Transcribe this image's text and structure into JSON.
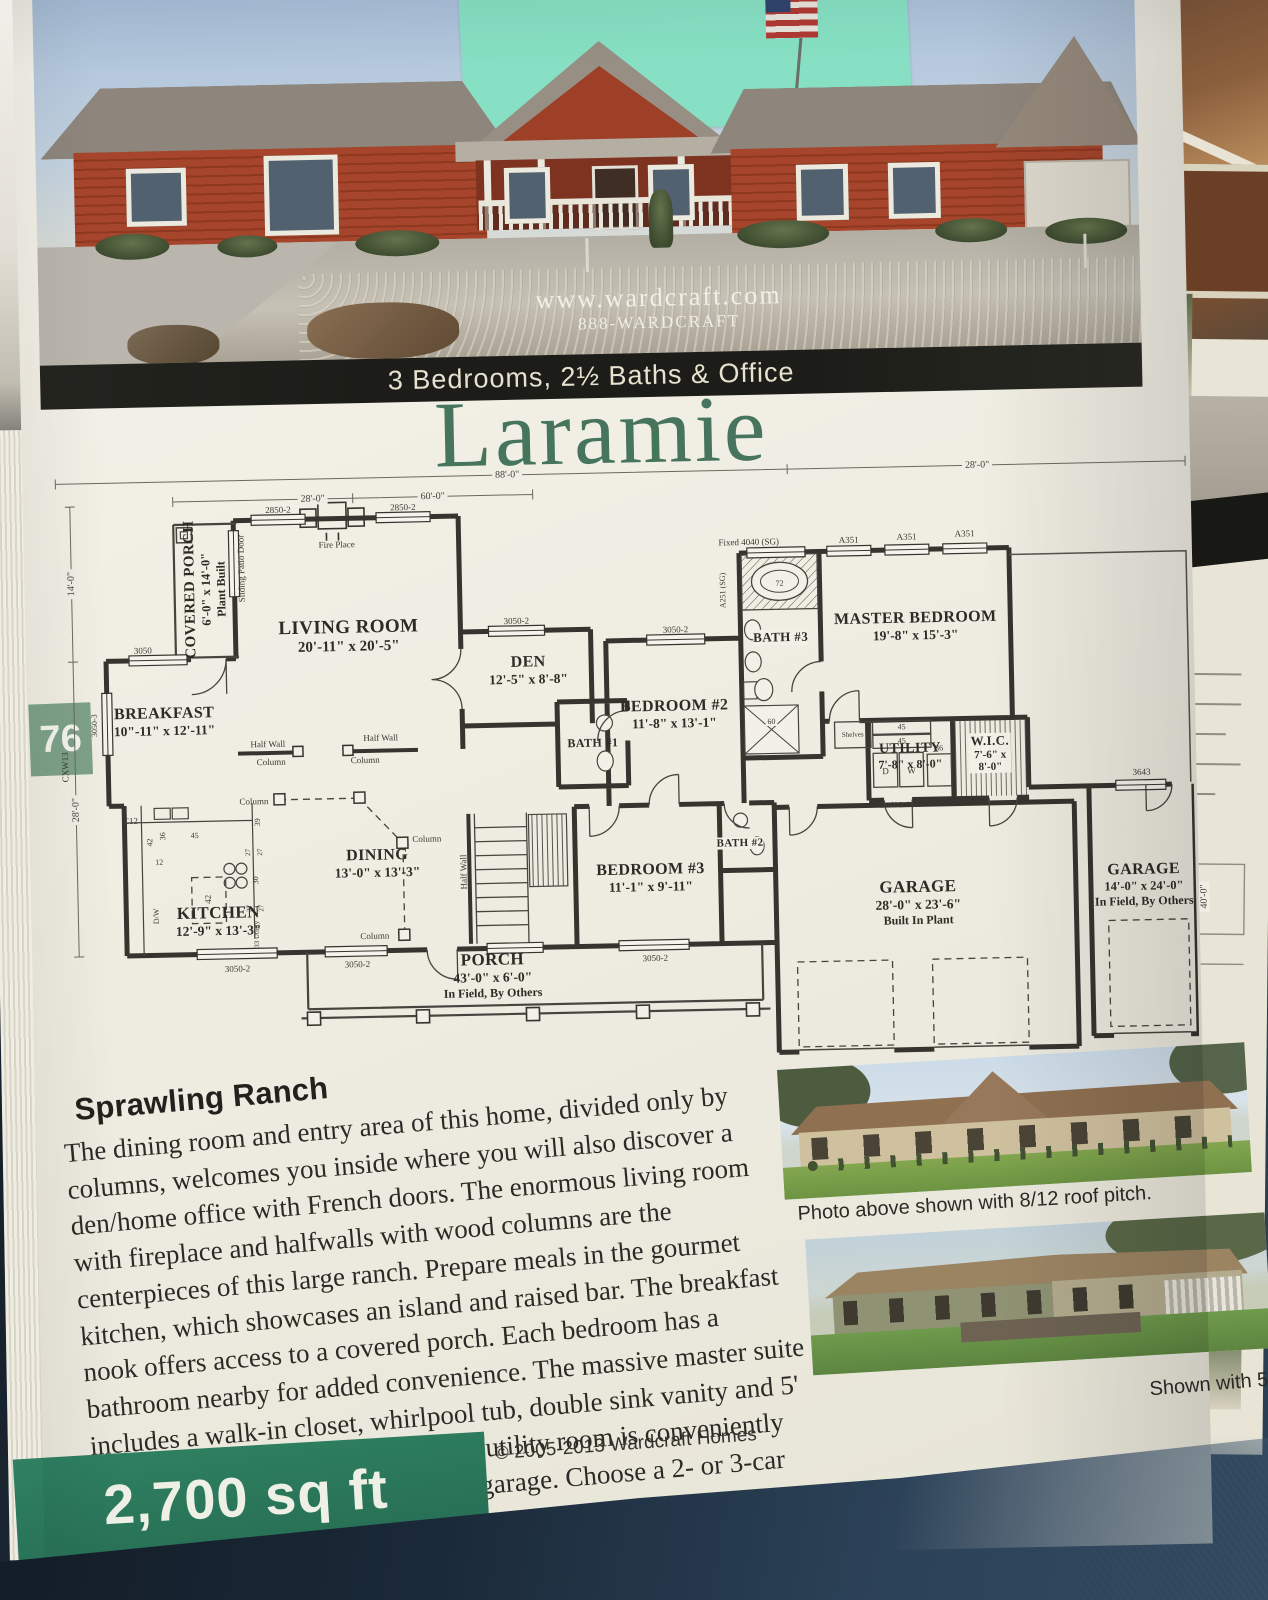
{
  "photo_header": {
    "watermark1": "www.wardcraft.com",
    "watermark2": "888-WARDCRAFT",
    "banner": "3 Bedrooms, 2½ Baths & Office",
    "sticker_color": "#87e0c3"
  },
  "title": "Laramie",
  "page_number": "76",
  "floorplan": {
    "rooms": [
      {
        "name": "COVERED PORCH",
        "dims": "6'-0\" x 14'-0\"",
        "note": "Plant Built"
      },
      {
        "name": "LIVING ROOM",
        "dims": "20'-11\" x 20'-5\""
      },
      {
        "name": "BREAKFAST",
        "dims": "10\"-11\" x 12'-11\""
      },
      {
        "name": "DEN",
        "dims": "12'-5\" x 8'-8\""
      },
      {
        "name": "BEDROOM #2",
        "dims": "11'-8\" x 13'-1\""
      },
      {
        "name": "MASTER BEDROOM",
        "dims": "19'-8\" x 15'-3\""
      },
      {
        "name": "BATH #3"
      },
      {
        "name": "BATH #1"
      },
      {
        "name": "UTILITY",
        "dims": "7'-8\" x 8'-0\""
      },
      {
        "name": "W.I.C.",
        "dims_line1": "7'-6\" x",
        "dims_line2": "8'-0\""
      },
      {
        "name": "DINING",
        "dims": "13'-0\" x 13'-3\""
      },
      {
        "name": "KITCHEN",
        "dims": "12'-9\" x 13'-3\""
      },
      {
        "name": "BEDROOM #3",
        "dims": "11'-1\" x 9'-11\""
      },
      {
        "name": "BATH #2"
      },
      {
        "name": "PORCH",
        "dims": "43'-0\" x 6'-0\"",
        "note": "In Field, By Others"
      },
      {
        "name": "GARAGE",
        "dims": "28'-0\" x 23'-6\"",
        "note": "Built In Plant"
      },
      {
        "name": "GARAGE",
        "dims": "14'-0\" x 24'-0\"",
        "note": "In Field, By Others"
      }
    ],
    "labels": {
      "fire_place": "Fire Place",
      "sliding_patio_door": "Sliding Patio Door",
      "half_wall": "Half Wall",
      "column": "Column",
      "shelf_and_pole": "Shelf & Pole",
      "shelves": "Shelves",
      "dryer": "D",
      "washer": "W",
      "dw": "D/W",
      "tub": "72",
      "shower": "60",
      "n45": "45",
      "n42": "42",
      "n36": "36",
      "n33": "33 Utility",
      "n39": "39",
      "n30": "30",
      "n27": "27",
      "n12": "12",
      "c12": "C12",
      "cxw13": "CXW13",
      "w2850": "2850-2",
      "w3050": "3050",
      "w3050_2": "3050-2",
      "w3050_3": "3050-3",
      "w3643": "3643",
      "fixed": "Fixed 4040 (SG)",
      "a351": "A351",
      "a251": "A251 (SG)"
    },
    "dims": {
      "overall": "88'-0\"",
      "right": "28'-0\"",
      "seg28": "28'-0\"",
      "seg60": "60'-0\"",
      "left14": "14'-0\"",
      "left28": "28'-0\"",
      "right40": "40'-0\""
    }
  },
  "article": {
    "heading": "Sprawling Ranch",
    "body": "The dining room and entry area of this home, divided only by columns, welcomes you inside where you will also discover a den/home office with French doors. The enormous living room with fireplace and halfwalls with wood columns are the centerpieces of this large ranch. Prepare meals in the gourmet kitchen, which showcases an island and raised bar. The breakfast nook offers access to a covered porch. Each bedroom has a bathroom nearby for added convenience. The massive master suite includes a walk-in closet, whirlpool tub, double sink vanity and 5' shower with dual showerheads. The utility room is conveniently located by the master bedroom and garage. Choose a 2- or 3-car garage.",
    "copyright": "© 2005-2013 Wardcraft Homes"
  },
  "photos": {
    "caption1": "Photo above shown with  8/12 roof pitch.",
    "caption2": "Shown with 5/12 roof"
  },
  "footer": {
    "sqft": "2,700 sq ft"
  }
}
